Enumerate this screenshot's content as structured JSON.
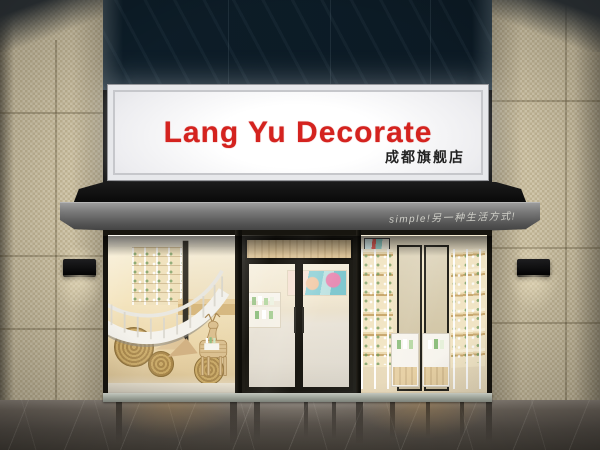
{
  "scene": {
    "kind": "storefront-photo",
    "store_sign": {
      "title": "Lang Yu Decorate",
      "subtitle": "成都旗舰店",
      "title_color": "#d4231f",
      "subtitle_color": "#222222",
      "panel_color": "#ffffff"
    },
    "awning": {
      "slogan": "simple!另一种生活方式!",
      "slogan_color": "#dadad2",
      "fascia_color": "#5a5a5a",
      "canopy_color": "#0d0d0d"
    },
    "facade": {
      "tile_color": "#c9be9f",
      "upper_glass_color": "#0d1d28",
      "floor_color": "#57514a"
    },
    "interior": {
      "theme_color": "#f2e4c2",
      "product_accent": "#7fae6e",
      "elements": [
        "spiral-staircase",
        "wooden-deer-display",
        "woven-disc-decor",
        "beauty-poster",
        "lit-product-shelves",
        "white-display-cabinets",
        "glass-entrance-door"
      ]
    }
  }
}
